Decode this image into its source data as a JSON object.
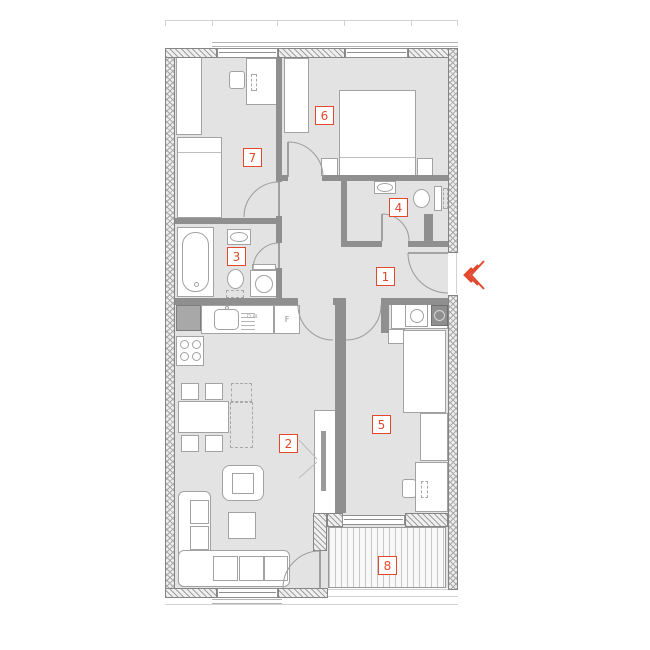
{
  "plan": {
    "room_labels": [
      {
        "number": "1"
      },
      {
        "number": "2"
      },
      {
        "number": "3"
      },
      {
        "number": "4"
      },
      {
        "number": "5"
      },
      {
        "number": "6"
      },
      {
        "number": "7"
      },
      {
        "number": "8"
      }
    ],
    "appliance_labels": {
      "fridge": "F",
      "dishwasher": "D.W."
    },
    "colors": {
      "label_accent": "#e2482e",
      "interior_wall": "#8f8f8f",
      "floor": "#e3e3e3",
      "furniture_outline": "#a2a2a2"
    }
  }
}
